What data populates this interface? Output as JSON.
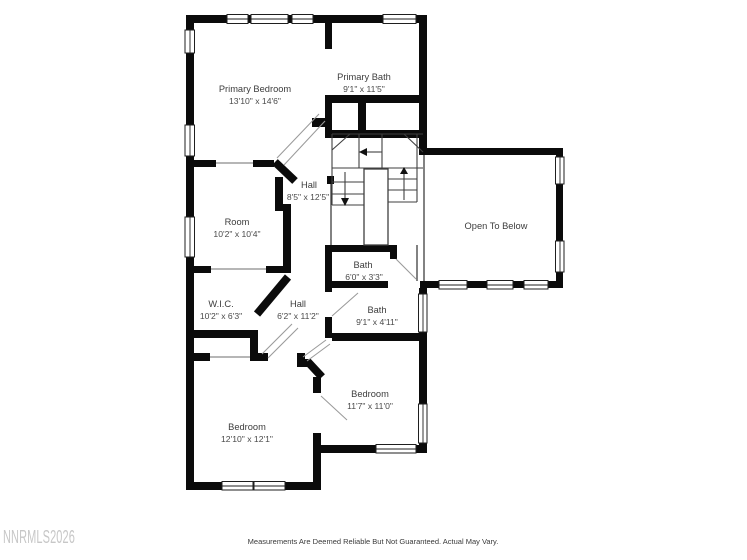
{
  "floorplan": {
    "rooms": {
      "primary_bedroom": {
        "name": "Primary Bedroom",
        "dims": "13'10\" x 14'6\""
      },
      "primary_bath": {
        "name": "Primary Bath",
        "dims": "9'1\" x 11'5\""
      },
      "hall_upper": {
        "name": "Hall",
        "dims": "8'5\" x 12'5\""
      },
      "room": {
        "name": "Room",
        "dims": "10'2\" x 10'4\""
      },
      "open_to_below": {
        "name": "Open To Below",
        "dims": ""
      },
      "bath_small": {
        "name": "Bath",
        "dims": "6'0\" x 3'3\""
      },
      "wic": {
        "name": "W.I.C.",
        "dims": "10'2\" x 6'3\""
      },
      "hall_lower": {
        "name": "Hall",
        "dims": "6'2\" x 11'2\""
      },
      "bath_main": {
        "name": "Bath",
        "dims": "9'1\" x 4'11\""
      },
      "bedroom_right": {
        "name": "Bedroom",
        "dims": "11'7\" x 11'0\""
      },
      "bedroom_left": {
        "name": "Bedroom",
        "dims": "12'10\" x 12'1\""
      }
    },
    "footer": {
      "disclaimer": "Measurements Are Deemed Reliable But Not Guaranteed. Actual May Vary."
    },
    "watermark": "NNRMLS2026",
    "icons": {
      "stair_up_arrow": "triangle-up",
      "stair_down_arrow": "triangle-down",
      "stair_turn_arrow": "triangle-left"
    },
    "colors": {
      "wall": "#0b0b0b",
      "thin_line": "#3f3f3f",
      "label_text": "#3d3d3d",
      "watermark": "#c7c7c7",
      "background": "#ffffff"
    }
  }
}
